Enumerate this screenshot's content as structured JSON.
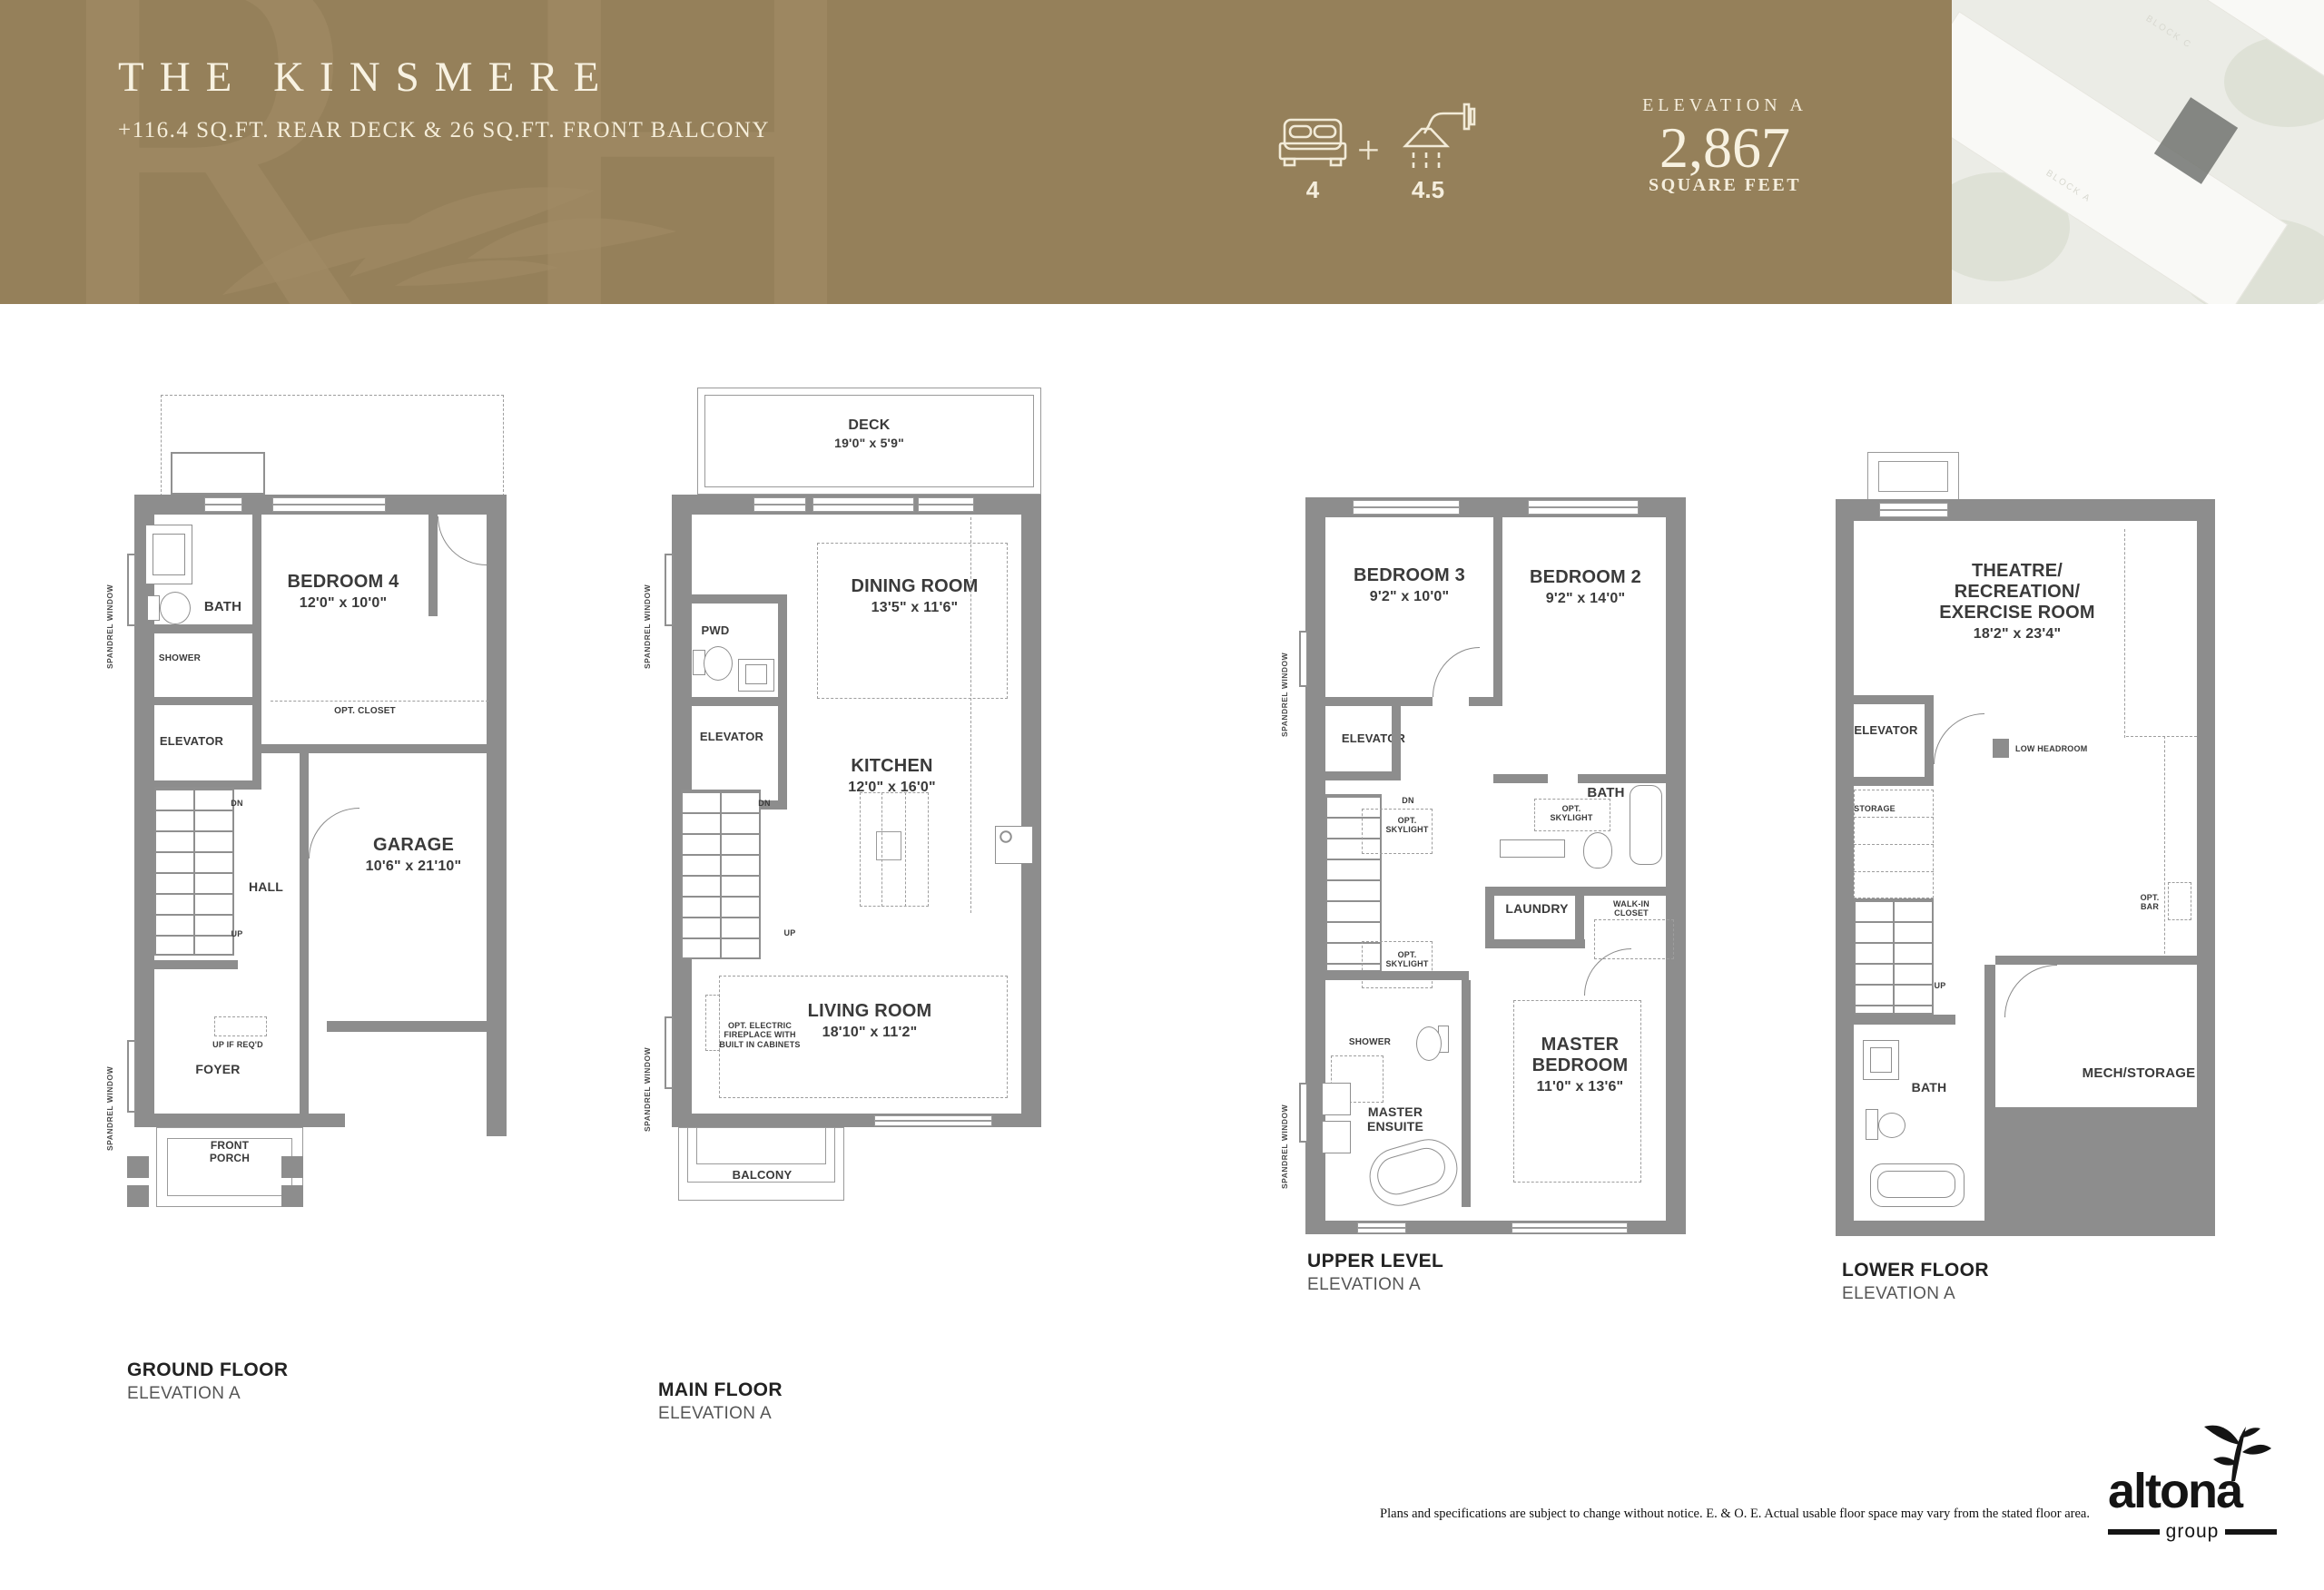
{
  "header": {
    "watermark": "RH",
    "title": "THE KINSMERE",
    "subtitle": "+116.4 SQ.FT. REAR DECK & 26 SQ.FT. FRONT BALCONY",
    "beds_count": "4",
    "plus": "+",
    "baths_count": "4.5",
    "elevation_label": "ELEVATION A",
    "area_value": "2,867",
    "area_label": "SQUARE FEET",
    "aerial_block_a": "BLOCK A",
    "aerial_block_c": "BLOCK C",
    "colors": {
      "band": "#95805a",
      "cream": "#f5eedd",
      "wall_gray": "#8d8d8d"
    }
  },
  "plans": {
    "ground": {
      "title": "GROUND FLOOR",
      "elevation": "ELEVATION A",
      "labels": {
        "bath": "BATH",
        "shower": "SHOWER",
        "elevator": "ELEVATOR",
        "bedroom": "BEDROOM 4",
        "bedroom_dim": "12'0\" x 10'0\"",
        "opt_closet": "OPT. CLOSET",
        "dn": "DN",
        "up": "UP",
        "hall": "HALL",
        "garage": "GARAGE",
        "garage_dim": "10'6\" x 21'10\"",
        "up_if_reqd": "UP IF REQ'D",
        "foyer": "FOYER",
        "front_porch": "FRONT PORCH",
        "spandrel": "SPANDREL WINDOW"
      }
    },
    "main": {
      "title": "MAIN FLOOR",
      "elevation": "ELEVATION A",
      "labels": {
        "deck": "DECK",
        "deck_dim": "19'0\" x 5'9\"",
        "dining": "DINING ROOM",
        "dining_dim": "13'5\" x 11'6\"",
        "pwd": "PWD",
        "elevator": "ELEVATOR",
        "kitchen": "KITCHEN",
        "kitchen_dim": "12'0\" x 16'0\"",
        "dn": "DN",
        "up": "UP",
        "living": "LIVING ROOM",
        "living_dim": "18'10\" x 11'2\"",
        "fireplace": "OPT. ELECTRIC FIREPLACE WITH BUILT IN CABINETS",
        "balcony": "BALCONY",
        "spandrel": "SPANDREL WINDOW"
      }
    },
    "upper": {
      "title": "UPPER LEVEL",
      "elevation": "ELEVATION A",
      "labels": {
        "bedroom3": "BEDROOM 3",
        "bedroom3_dim": "9'2\" x 10'0\"",
        "bedroom2": "BEDROOM 2",
        "bedroom2_dim": "9'2\" x 14'0\"",
        "elevator": "ELEVATOR",
        "bath": "BATH",
        "opt_skylight": "OPT. SKYLIGHT",
        "dn": "DN",
        "laundry": "LAUNDRY",
        "walkin": "WALK-IN CLOSET",
        "shower": "SHOWER",
        "ensuite": "MASTER ENSUITE",
        "master": "MASTER BEDROOM",
        "master_dim": "11'0\" x 13'6\"",
        "spandrel": "SPANDREL WINDOW"
      }
    },
    "lower": {
      "title": "LOWER FLOOR",
      "elevation": "ELEVATION A",
      "labels": {
        "theatre": "THEATRE/ RECREATION/ EXERCISE ROOM",
        "theatre_dim": "18'2\" x 23'4\"",
        "elevator": "ELEVATOR",
        "low_headroom": "LOW HEADROOM",
        "storage": "STORAGE",
        "up": "UP",
        "opt_bar": "OPT. BAR",
        "bath": "BATH",
        "mech": "MECH/STORAGE"
      }
    }
  },
  "footer": {
    "disclaimer": "Plans and specifications are subject to change without notice.  E. & O. E. Actual usable floor space may vary from the stated floor area.",
    "logo_name": "altona",
    "logo_sub": "group"
  }
}
